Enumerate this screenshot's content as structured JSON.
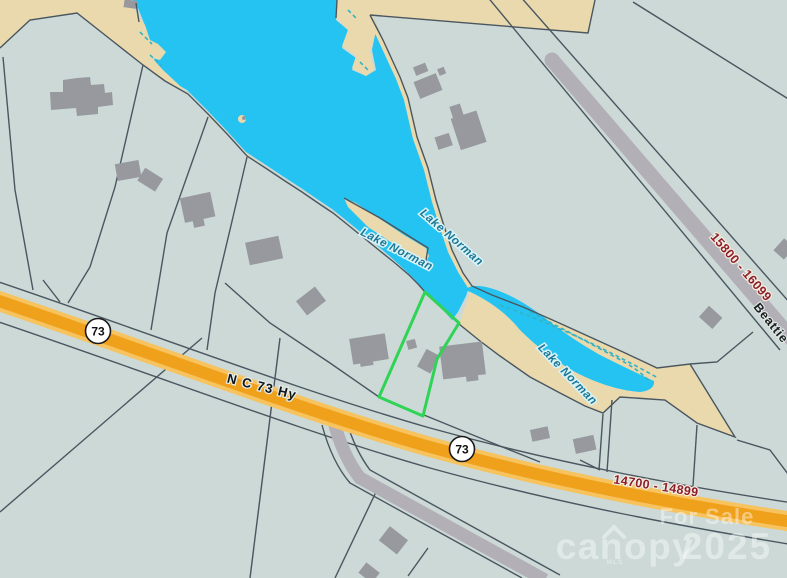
{
  "map": {
    "lake_labels": [
      "Lake Norman",
      "Lake Norman",
      "Lake Norman"
    ],
    "roads": {
      "highway_label": "N C 73 Hy",
      "beattie_label": "Beattie",
      "route_shields": [
        "73",
        "73"
      ]
    },
    "address_ranges": [
      "15800 - 16099",
      "14700 - 14899"
    ],
    "watermark": {
      "for_sale": "For Sale",
      "brand": "canopy",
      "brand_sub": "MLS",
      "year": "2025"
    },
    "colors": {
      "water": "#25c3f1",
      "land": "#ccd9d6",
      "shore": "#e9d9ad",
      "highway_core": "#f0a11c",
      "highway_casing": "#f6c35f",
      "gray_road": "#b2afb7",
      "parcel_line": "#4a5660",
      "building": "#98999e",
      "highlight_parcel": "#2fd355",
      "address_text": "#8e1e2d",
      "lake_text": "#1c7795"
    }
  }
}
